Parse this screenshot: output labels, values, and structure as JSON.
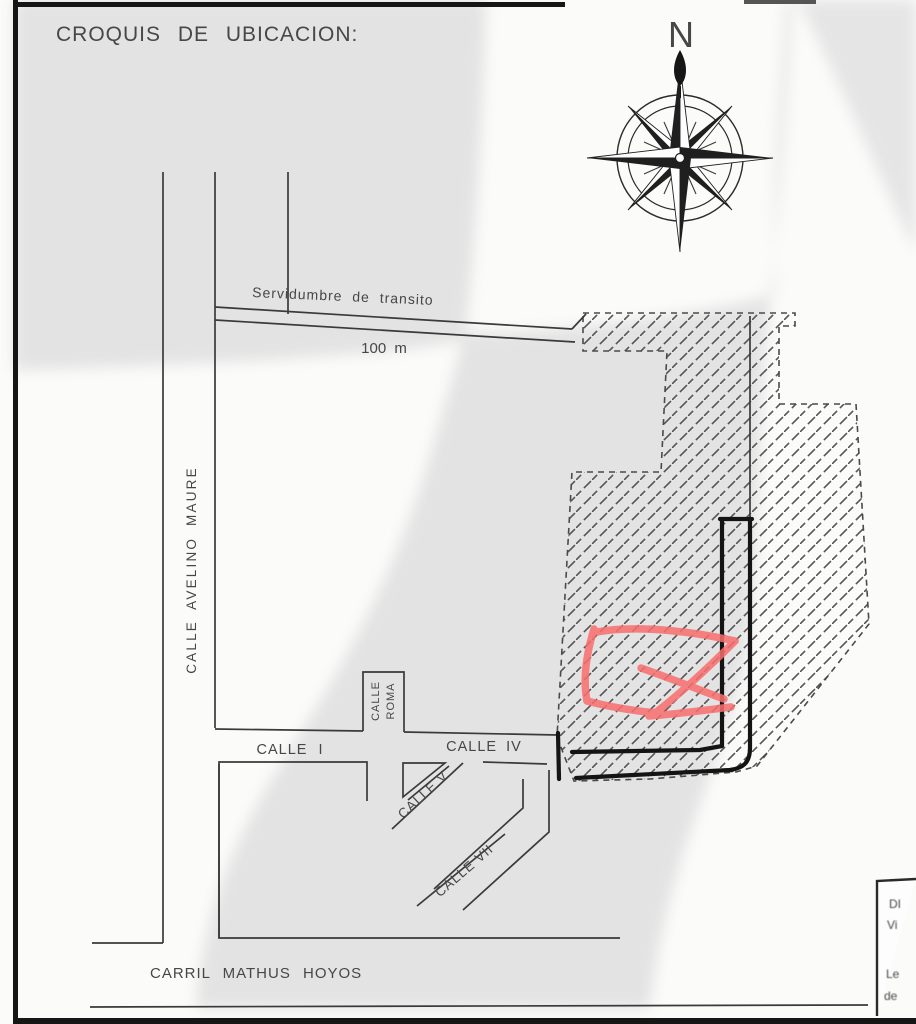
{
  "title": "CROQUIS DE UBICACION:",
  "compass": {
    "north_label": "N"
  },
  "map": {
    "easement_label": "Servidumbre de transito",
    "scale_label": "100 m",
    "streets": {
      "avelino_maure": "CALLE AVELINO MAURE",
      "roma_line1": "CALLE",
      "roma_line2": "ROMA",
      "calle_i": "CALLE I",
      "calle_iv": "CALLE IV",
      "calle_v": "CALLE V",
      "calle_vii": "CALLE VII",
      "carril": "CARRIL MATHUS HOYOS"
    }
  },
  "sidebox": {
    "fragments": [
      "DI",
      "Vi",
      "Le",
      "de"
    ]
  },
  "colors": {
    "annotation_red": "#f96e6e",
    "watermark_gray": "#e3e3e3",
    "ink": "#333333",
    "hatch": "#4f4f4f"
  }
}
